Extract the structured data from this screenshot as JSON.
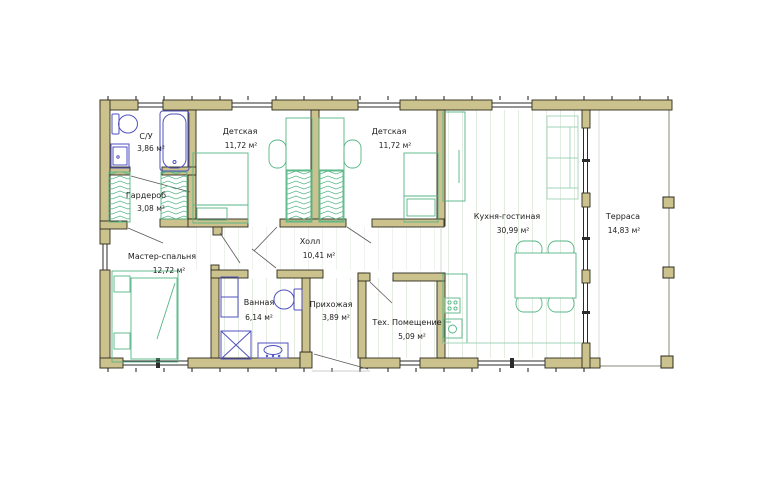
{
  "plan": {
    "rooms": [
      {
        "id": "su",
        "name": "С/У",
        "area": "3,86 м²"
      },
      {
        "id": "garderob",
        "name": "Гардероб",
        "area": "3,08 м²"
      },
      {
        "id": "detskaya-1",
        "name": "Детская",
        "area": "11,72 м²"
      },
      {
        "id": "detskaya-2",
        "name": "Детская",
        "area": "11,72 м²"
      },
      {
        "id": "kitchen-living",
        "name": "Кухня-гостиная",
        "area": "30,99 м²"
      },
      {
        "id": "terrace",
        "name": "Терраса",
        "area": "14,83 м²"
      },
      {
        "id": "master-bedroom",
        "name": "Мастер-спальня",
        "area": "12,72 м²"
      },
      {
        "id": "hall",
        "name": "Холл",
        "area": "10,41 м²"
      },
      {
        "id": "bathroom",
        "name": "Ванная",
        "area": "6,14 м²"
      },
      {
        "id": "entry",
        "name": "Прихожая",
        "area": "3,89 м²"
      },
      {
        "id": "tech-room",
        "name": "Тех. Помещение",
        "area": "5,09 м²"
      }
    ],
    "colors": {
      "wall_fill": "#cbc28e",
      "wall_outline": "#2e2b1c",
      "furniture_green": "#55b585",
      "furniture_light_green": "#9fd4b8",
      "fixture_blue": "#5052c0",
      "floor_line": "#e4ebe1"
    },
    "fixtures": [
      "toilet",
      "sink",
      "bathtub",
      "wardrobe",
      "bed",
      "sofa",
      "dining-table",
      "chair",
      "stove",
      "kitchen-sink",
      "shower",
      "cabinet",
      "terrace-post"
    ]
  }
}
